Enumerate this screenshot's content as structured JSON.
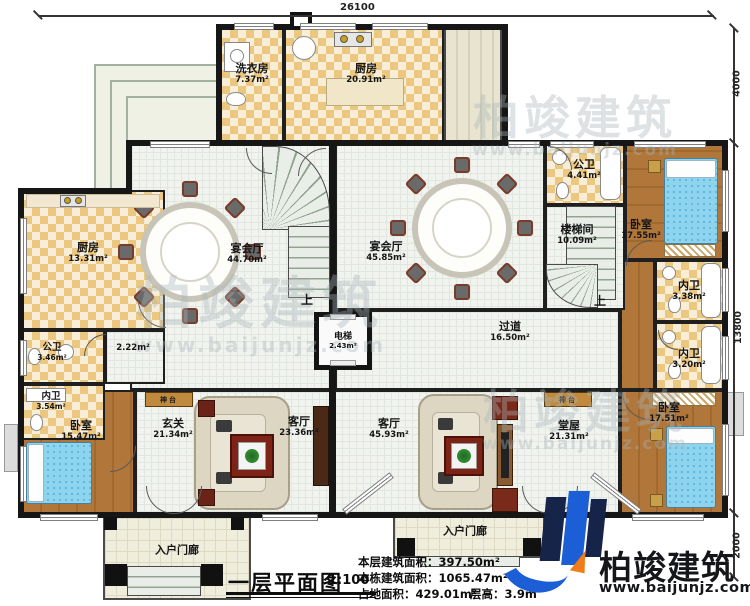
{
  "title_block": {
    "title": "一层平面图",
    "scale": "1:100"
  },
  "stats": {
    "floor_area": "本层建筑面积：397.50m²",
    "building_area": "本栋建筑面积：1065.47m²",
    "land_area": "占地面积：429.01m²",
    "floor_height": "层高：3.9m"
  },
  "dimensions": {
    "top": "26100",
    "right_top": "4000",
    "right_middle": "13800",
    "right_bottom": "2000"
  },
  "logo": {
    "name": "柏竣建筑",
    "url": "www.baijunjz.com"
  },
  "watermark": {
    "name": "柏竣建筑",
    "url": "www.baijunjz.com"
  },
  "rooms": {
    "laundry": {
      "name": "洗衣房",
      "area": "7.37m²"
    },
    "kitchen_top": {
      "name": "厨房",
      "area": "20.91m²"
    },
    "banquet_left": {
      "name": "宴会厅",
      "area": "44.70m²"
    },
    "banquet_right": {
      "name": "宴会厅",
      "area": "45.85m²"
    },
    "public_bath_top": {
      "name": "公卫",
      "area": "4.41m²"
    },
    "bedroom_top_right": {
      "name": "卧室",
      "area": "17.55m²"
    },
    "stair_hall": {
      "name": "楼梯间",
      "area": "10.09m²"
    },
    "inner_bath_1": {
      "name": "内卫",
      "area": "3.38m²"
    },
    "inner_bath_2": {
      "name": "内卫",
      "area": "3.20m²"
    },
    "hallway": {
      "name": "过道",
      "area": "16.50m²"
    },
    "elevator": {
      "name": "电梯",
      "area": "2.43m²"
    },
    "kitchen_left": {
      "name": "厨房",
      "area": "13.31m²"
    },
    "public_bath_left": {
      "name": "公卫",
      "area": "3.46m²"
    },
    "small_hall": {
      "area": "2.22m²"
    },
    "inner_bath_left": {
      "name": "内卫",
      "area": "3.54m²"
    },
    "bedroom_left": {
      "name": "卧室",
      "area": "15.47m²"
    },
    "foyer": {
      "name": "玄关",
      "area": "21.34m²"
    },
    "living_left": {
      "name": "客厅",
      "area": "23.36m²"
    },
    "living_right": {
      "name": "客厅",
      "area": "45.93m²"
    },
    "hall_right": {
      "name": "堂屋",
      "area": "21.31m²"
    },
    "bedroom_bottom_right": {
      "name": "卧室",
      "area": "17.51m²"
    },
    "porch_left": {
      "name": "入户门廊"
    },
    "porch_right": {
      "name": "入户门廊"
    }
  },
  "symbols": {
    "up": "上",
    "altar": "神台"
  }
}
